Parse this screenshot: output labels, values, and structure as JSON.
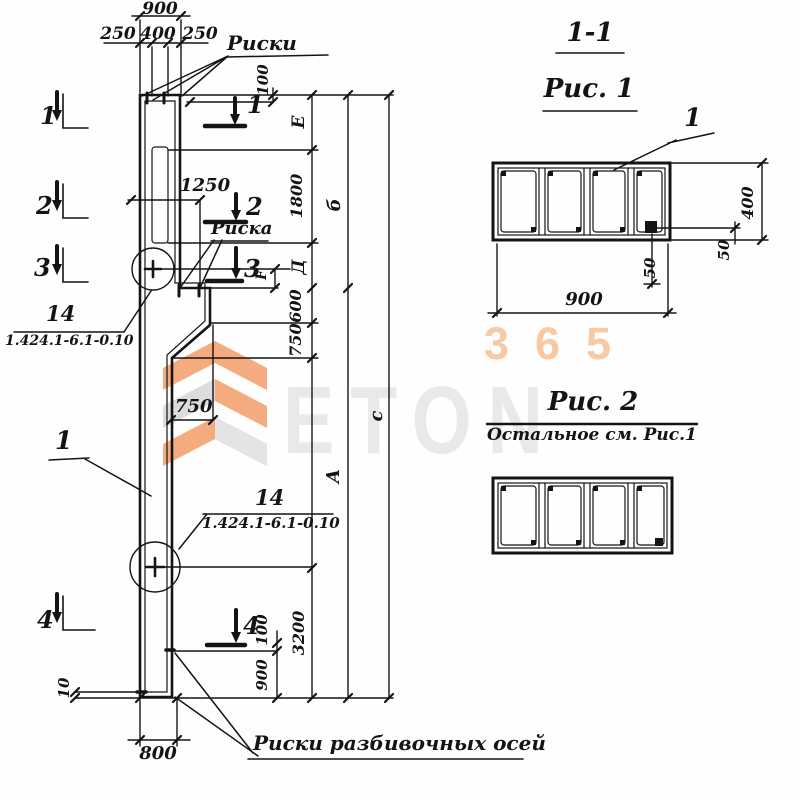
{
  "watermark": {
    "brand": "ETON",
    "number": "365"
  },
  "elevation": {
    "dim_900_top": "900",
    "dim_250_left": "250",
    "dim_400": "400",
    "dim_250_right": "250",
    "label_riski": "Риски",
    "label_riska": "Риска",
    "label_riski_axes": "Риски разбивочных осей",
    "dim_100_top": "100",
    "dim_1250": "1250",
    "dim_1800": "1800",
    "dim_600": "600",
    "dim_750_vert": "750",
    "dim_750_horiz": "750",
    "dim_3200": "3200",
    "dim_100_bottom": "100",
    "dim_900_bottom": "900",
    "dim_800": "800",
    "dim_10": "10",
    "letter_E": "Е",
    "letter_b": "б",
    "letter_D": "Д",
    "letter_A": "А",
    "letter_C": "с",
    "letter_F": "F",
    "sec1": "1",
    "sec2": "2",
    "sec3": "3",
    "sec4": "4",
    "callout_14_upper": {
      "mark": "14",
      "series": "1.424.1-6.1-0.10"
    },
    "callout_14_lower": {
      "mark": "14",
      "series": "1.424.1-6.1-0.10"
    },
    "callout_pos1": "1"
  },
  "fig1": {
    "section_ref": "1-1",
    "title": "Рис. 1",
    "pos": "1",
    "dim_900": "900",
    "dim_400": "400",
    "dim_50_right": "50",
    "dim_50_bottom": "50"
  },
  "fig2": {
    "title": "Рис. 2",
    "note": "Остальное см. Рис.1"
  }
}
